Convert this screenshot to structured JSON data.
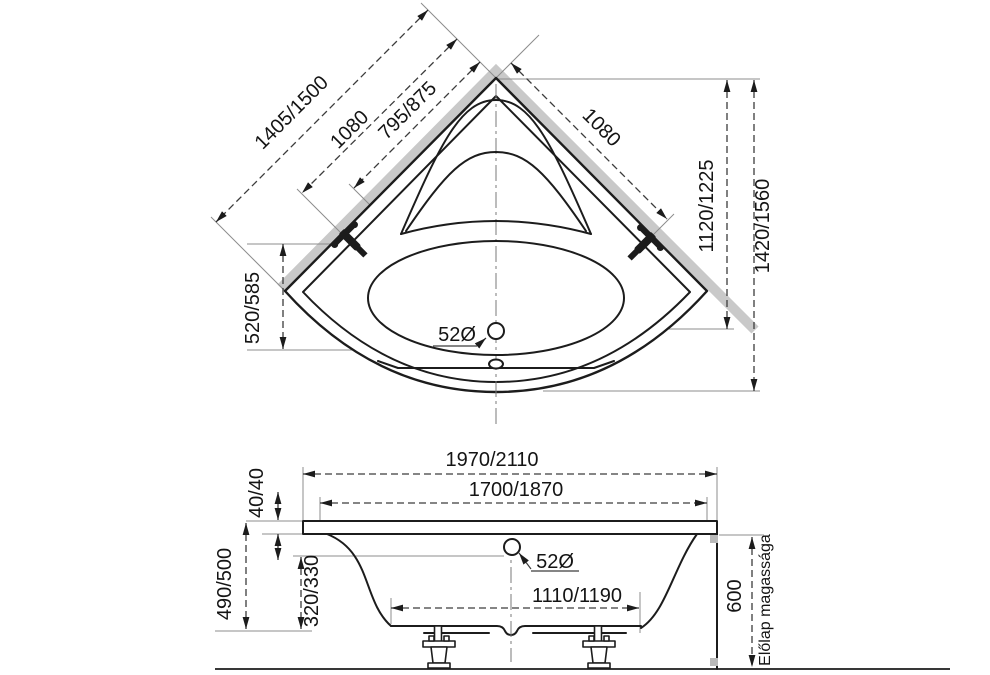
{
  "drawing_type": "corner-bathtub-technical-drawing",
  "colors": {
    "line": "#1c1c1c",
    "wall_band": "#c9c9c9",
    "extension_line": "#8c8c8c"
  },
  "top_view": {
    "dim_side_full": "1405/1500",
    "dim_side_wall": "1080",
    "dim_side_inner": "795/875",
    "dim_side_right": "1080",
    "dim_vertical_inner": "1120/1225",
    "dim_vertical_outer": "1420/1560",
    "dim_vertical_left": "520/585",
    "drain_diameter": "52Ø"
  },
  "side_view": {
    "dim_width_outer": "1970/2110",
    "dim_width_inner": "1700/1870",
    "dim_rim_thickness": "40/40",
    "dim_height_total": "490/500",
    "dim_depth_inner": "320/330",
    "dim_bottom_length": "1110/1190",
    "overflow_diameter": "52Ø",
    "dim_panel_height": "600",
    "panel_height_label": "Előlap magassága"
  }
}
